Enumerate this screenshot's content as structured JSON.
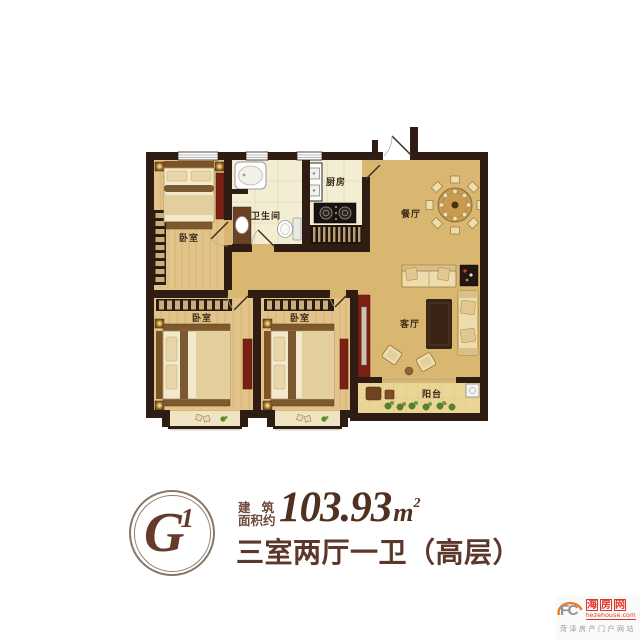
{
  "plan": {
    "rooms": {
      "bedroom_top": "卧室",
      "bathroom": "卫生间",
      "kitchen": "厨房",
      "dining": "餐厅",
      "living": "客厅",
      "bedroom_left": "卧室",
      "bedroom_mid": "卧室",
      "balcony": "阳台"
    }
  },
  "info": {
    "unit_code": "G",
    "unit_sup": "1",
    "area_label_line1": "建 筑",
    "area_label_line2": "面积约",
    "area_value": "103.93",
    "area_unit": "m",
    "area_unit_sup": "2",
    "layout_text": "三室两厅一卫（高层）"
  },
  "watermark": {
    "logo_text": "FC",
    "site_chars": [
      "海",
      "房",
      "网"
    ],
    "domain": "hezehouse.com",
    "tagline": "菏泽房产门户网站"
  },
  "colors": {
    "wall": "#2f1c12",
    "floor_main": "#d9b771",
    "floor_wood": "#e2c389",
    "floor_tile": "#f3edd3",
    "floor_balcony": "#e9d595",
    "accent_red": "#7a2015",
    "text_brown": "#5d382a",
    "watermark_red": "#e0352a",
    "watermark_orange": "#f07b1c"
  }
}
